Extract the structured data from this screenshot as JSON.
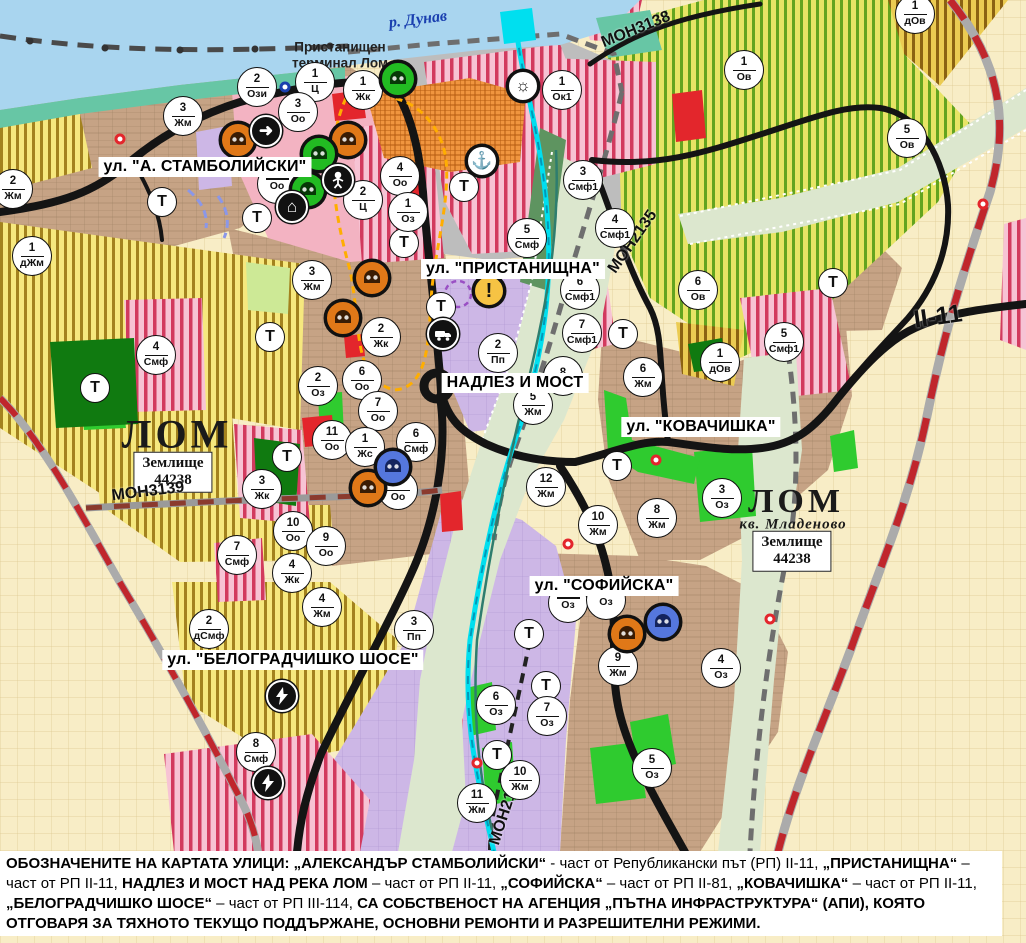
{
  "map": {
    "colors": {
      "water": "#A9D5EF",
      "shore_teal": "#67C6A5",
      "urban_brown": "#C6A385",
      "zone_yellow": "#F6E87E",
      "zone_olive": "#E7E465",
      "zone_gold": "#EBCB52",
      "zone_pink_stripe": "#D23A5E",
      "zone_purple": "#CDB7E6",
      "zone_cream": "#F8EDC6",
      "valley_sage": "#DCE7CE",
      "port_gray": "#BDBDBD",
      "terminal_orange": "#F0953F",
      "park_green": "#107A10",
      "greenery": "#2FCB2F",
      "zone_red": "#E3262C",
      "road_black": "#141414",
      "rail_red": "#C0262C",
      "canal_cyan": "#00DFEF",
      "boundary_orange": "#FFAE00"
    },
    "river_label": {
      "text": "р. Дунав",
      "x": 418,
      "y": 20,
      "rot": -7
    },
    "terminal_label": {
      "line1": "Пристанищен",
      "line2": "терминал Лом",
      "x": 340,
      "y": 55
    },
    "street_labels": [
      {
        "text": "ул. \"А. СТАМБОЛИЙСКИ\"",
        "x": 205,
        "y": 167
      },
      {
        "text": "ул. \"ПРИСТАНИЩНА\"",
        "x": 513,
        "y": 269
      },
      {
        "text": "НАДЛЕЗ И МОСТ",
        "x": 515,
        "y": 383
      },
      {
        "text": "ул. \"КОВАЧИШКА\"",
        "x": 701,
        "y": 427
      },
      {
        "text": "ул. \"СОФИЙСКА\"",
        "x": 604,
        "y": 586
      },
      {
        "text": "ул. \"БЕЛОГРАДЧИШКО ШОСЕ\"",
        "x": 293,
        "y": 660
      }
    ],
    "road_labels": [
      {
        "text": "MOH3138",
        "x": 636,
        "y": 30,
        "rot": -22,
        "big": false
      },
      {
        "text": "MOH2135",
        "x": 633,
        "y": 242,
        "rot": -55,
        "big": false
      },
      {
        "text": "MOH3139",
        "x": 148,
        "y": 492,
        "rot": -7,
        "big": false
      },
      {
        "text": "MOH2136",
        "x": 506,
        "y": 810,
        "rot": -72,
        "big": false
      },
      {
        "text": "II-11",
        "x": 938,
        "y": 317,
        "rot": -8,
        "big": true
      }
    ],
    "place_labels": [
      {
        "text": "ЛОМ",
        "x": 177,
        "y": 434,
        "size": 40
      },
      {
        "text": "ЛОМ",
        "x": 796,
        "y": 502,
        "size": 34
      }
    ],
    "place_sublabels": [
      {
        "text": "кв. Младеново",
        "x": 793,
        "y": 525
      }
    ],
    "zemlishte_boxes": [
      {
        "line1": "Землище",
        "line2": "44238",
        "x": 173,
        "y": 472
      },
      {
        "line1": "Землище",
        "line2": "44238",
        "x": 792,
        "y": 551
      }
    ],
    "zone_markers": [
      {
        "num": "2",
        "code": "Ози",
        "x": 257,
        "y": 87
      },
      {
        "num": "1",
        "code": "Ц",
        "x": 315,
        "y": 82
      },
      {
        "num": "3",
        "code": "Оо",
        "x": 298,
        "y": 112
      },
      {
        "num": "1",
        "code": "Жк",
        "x": 363,
        "y": 90
      },
      {
        "num": "1",
        "code": "Ок1",
        "x": 562,
        "y": 90
      },
      {
        "num": "3",
        "code": "Жм",
        "x": 183,
        "y": 116
      },
      {
        "num": "2",
        "code": "Жм",
        "x": 13,
        "y": 189
      },
      {
        "num": "1",
        "code": "дЖм",
        "x": 32,
        "y": 256
      },
      {
        "num": "4",
        "code": "Оо",
        "x": 400,
        "y": 176
      },
      {
        "num": "2",
        "code": "Ц",
        "x": 363,
        "y": 200
      },
      {
        "num": "1",
        "code": "Оз",
        "x": 408,
        "y": 212
      },
      {
        "num": "",
        "code": "Оо",
        "x": 277,
        "y": 184
      },
      {
        "num": "3",
        "code": "Смф1",
        "x": 583,
        "y": 180
      },
      {
        "num": "4",
        "code": "Смф1",
        "x": 615,
        "y": 228
      },
      {
        "num": "5",
        "code": "Смф",
        "x": 527,
        "y": 238
      },
      {
        "num": "6",
        "code": "Смф1",
        "x": 580,
        "y": 290
      },
      {
        "num": "7",
        "code": "Смф1",
        "x": 582,
        "y": 333
      },
      {
        "num": "2",
        "code": "Пп",
        "x": 498,
        "y": 353
      },
      {
        "num": "8",
        "code": "",
        "x": 563,
        "y": 376
      },
      {
        "num": "3",
        "code": "Жм",
        "x": 312,
        "y": 280
      },
      {
        "num": "2",
        "code": "Жк",
        "x": 381,
        "y": 337
      },
      {
        "num": "2",
        "code": "Оз",
        "x": 318,
        "y": 386
      },
      {
        "num": "6",
        "code": "Оо",
        "x": 362,
        "y": 380
      },
      {
        "num": "7",
        "code": "Оо",
        "x": 378,
        "y": 411
      },
      {
        "num": "11",
        "code": "Оо",
        "x": 332,
        "y": 440
      },
      {
        "num": "1",
        "code": "Жс",
        "x": 365,
        "y": 447
      },
      {
        "num": "6",
        "code": "Смф",
        "x": 416,
        "y": 442
      },
      {
        "num": "8",
        "code": "Оо",
        "x": 398,
        "y": 490
      },
      {
        "num": "3",
        "code": "Жк",
        "x": 262,
        "y": 489
      },
      {
        "num": "10",
        "code": "Оо",
        "x": 293,
        "y": 531
      },
      {
        "num": "9",
        "code": "Оо",
        "x": 326,
        "y": 546
      },
      {
        "num": "7",
        "code": "Смф",
        "x": 237,
        "y": 555
      },
      {
        "num": "4",
        "code": "Жк",
        "x": 292,
        "y": 573
      },
      {
        "num": "4",
        "code": "Смф",
        "x": 156,
        "y": 355
      },
      {
        "num": "4",
        "code": "Жм",
        "x": 322,
        "y": 607
      },
      {
        "num": "2",
        "code": "дСмф",
        "x": 209,
        "y": 629
      },
      {
        "num": "3",
        "code": "Пп",
        "x": 414,
        "y": 630
      },
      {
        "num": "8",
        "code": "Смф",
        "x": 256,
        "y": 752
      },
      {
        "num": "6",
        "code": "Жм",
        "x": 643,
        "y": 377
      },
      {
        "num": "5",
        "code": "Жм",
        "x": 533,
        "y": 405
      },
      {
        "num": "12",
        "code": "Жм",
        "x": 546,
        "y": 487
      },
      {
        "num": "8",
        "code": "Жм",
        "x": 657,
        "y": 518
      },
      {
        "num": "3",
        "code": "Оз",
        "x": 722,
        "y": 498
      },
      {
        "num": "10",
        "code": "Жм",
        "x": 598,
        "y": 525
      },
      {
        "num": "9",
        "code": "Жм",
        "x": 618,
        "y": 666
      },
      {
        "num": "4",
        "code": "Оз",
        "x": 721,
        "y": 668
      },
      {
        "num": "6",
        "code": "Оз",
        "x": 496,
        "y": 705
      },
      {
        "num": "7",
        "code": "Оз",
        "x": 547,
        "y": 716
      },
      {
        "num": "5",
        "code": "Оз",
        "x": 652,
        "y": 768
      },
      {
        "num": "10",
        "code": "Жм",
        "x": 520,
        "y": 780
      },
      {
        "num": "11",
        "code": "Жм",
        "x": 477,
        "y": 803
      },
      {
        "num": "1",
        "code": "Ов",
        "x": 744,
        "y": 70
      },
      {
        "num": "5",
        "code": "Ов",
        "x": 907,
        "y": 138
      },
      {
        "num": "1",
        "code": "дОв",
        "x": 915,
        "y": 14
      },
      {
        "num": "6",
        "code": "Ов",
        "x": 698,
        "y": 290
      },
      {
        "num": "1",
        "code": "дОв",
        "x": 720,
        "y": 362
      },
      {
        "num": "5",
        "code": "Смф1",
        "x": 784,
        "y": 342
      },
      {
        "num": "",
        "code": "Оз",
        "x": 568,
        "y": 603
      },
      {
        "num": "",
        "code": "Оз",
        "x": 606,
        "y": 600
      }
    ],
    "transport_markers": [
      {
        "x": 162,
        "y": 202
      },
      {
        "x": 257,
        "y": 218
      },
      {
        "x": 404,
        "y": 243
      },
      {
        "x": 441,
        "y": 307
      },
      {
        "x": 270,
        "y": 337
      },
      {
        "x": 287,
        "y": 457
      },
      {
        "x": 95,
        "y": 388
      },
      {
        "x": 464,
        "y": 187
      },
      {
        "x": 623,
        "y": 334
      },
      {
        "x": 833,
        "y": 283
      },
      {
        "x": 617,
        "y": 466
      },
      {
        "x": 529,
        "y": 634
      },
      {
        "x": 546,
        "y": 686
      },
      {
        "x": 497,
        "y": 755
      }
    ],
    "transport_letter": "Т",
    "icon_markers": [
      {
        "type": "monument-orange",
        "x": 238,
        "y": 140
      },
      {
        "type": "monument-orange",
        "x": 348,
        "y": 140
      },
      {
        "type": "monument-orange",
        "x": 372,
        "y": 278
      },
      {
        "type": "monument-orange",
        "x": 343,
        "y": 318
      },
      {
        "type": "monument-orange",
        "x": 368,
        "y": 488
      },
      {
        "type": "monument-orange",
        "x": 627,
        "y": 634
      },
      {
        "type": "monument-green",
        "x": 398,
        "y": 79
      },
      {
        "type": "monument-green",
        "x": 319,
        "y": 154
      },
      {
        "type": "monument-green",
        "x": 308,
        "y": 190
      },
      {
        "type": "monument-blue",
        "x": 393,
        "y": 467
      },
      {
        "type": "monument-blue",
        "x": 663,
        "y": 622
      },
      {
        "type": "arrow",
        "x": 266,
        "y": 131
      },
      {
        "type": "person",
        "x": 338,
        "y": 180
      },
      {
        "type": "arch",
        "x": 292,
        "y": 207
      },
      {
        "type": "anchor",
        "x": 482,
        "y": 161
      },
      {
        "type": "sun",
        "x": 523,
        "y": 86
      },
      {
        "type": "truck",
        "x": 443,
        "y": 334
      },
      {
        "type": "warning",
        "x": 489,
        "y": 291
      },
      {
        "type": "lightning",
        "x": 282,
        "y": 696
      },
      {
        "type": "lightning",
        "x": 268,
        "y": 783
      }
    ],
    "point_markers": [
      {
        "kind": "red-ring",
        "x": 120,
        "y": 139
      },
      {
        "kind": "red-ring",
        "x": 656,
        "y": 460
      },
      {
        "kind": "red-ring",
        "x": 568,
        "y": 544
      },
      {
        "kind": "red-ring",
        "x": 770,
        "y": 619
      },
      {
        "kind": "red-ring",
        "x": 983,
        "y": 204
      },
      {
        "kind": "red-ring",
        "x": 477,
        "y": 763
      },
      {
        "kind": "blue-ring",
        "x": 285,
        "y": 87
      }
    ],
    "caption_segments": [
      {
        "b": 1,
        "t": "ОБОЗНАЧЕНИТЕ НА КАРТАТА УЛИЦИ: "
      },
      {
        "b": 1,
        "t": "„АЛЕКСАНДЪР СТАМБОЛИЙСКИ“"
      },
      {
        "b": 0,
        "t": " - част от Републикански път (РП) II-11, "
      },
      {
        "b": 1,
        "t": "„ПРИСТАНИЩНА“"
      },
      {
        "b": 0,
        "t": " – част от РП II-11, "
      },
      {
        "b": 1,
        "t": "НАДЛЕЗ И МОСТ НАД РЕКА ЛОМ"
      },
      {
        "b": 0,
        "t": " – част от РП II-11, "
      },
      {
        "b": 1,
        "t": "„СОФИЙСКА“"
      },
      {
        "b": 0,
        "t": " – част от РП II-81, "
      },
      {
        "b": 1,
        "t": "„КОВАЧИШКА“"
      },
      {
        "b": 0,
        "t": " – част от РП II-11, "
      },
      {
        "b": 1,
        "t": "„БЕЛОГРАДЧИШКО ШОСЕ“"
      },
      {
        "b": 0,
        "t": " – част от РП III-114, "
      },
      {
        "b": 1,
        "t": "СА СОБСТВЕНОСТ НА АГЕНЦИЯ „ПЪТНА ИНФРАСТРУКТУРА“ (АПИ), КОЯТО ОТГОВАРЯ ЗА ТЯХНОТО ТЕКУЩО ПОДДЪРЖАНЕ, ОСНОВНИ РЕМОНТИ И РАЗРЕШИТЕЛНИ РЕЖИМИ."
      }
    ]
  }
}
